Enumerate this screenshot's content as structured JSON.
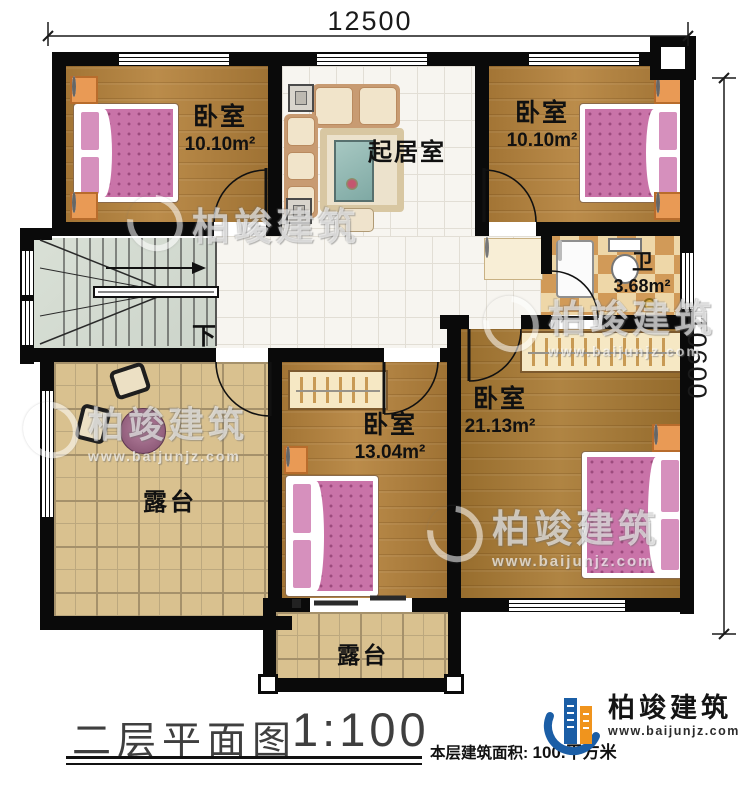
{
  "dimensions": {
    "width_label": "12500",
    "height_label": "10600"
  },
  "rooms": {
    "bedroom_top_left": {
      "label": "卧室",
      "area": "10.10m²"
    },
    "living_room": {
      "label": "起居室"
    },
    "bedroom_top_right": {
      "label": "卧室",
      "area": "10.10m²"
    },
    "bathroom": {
      "label": "卫",
      "area": "3.68m²"
    },
    "bedroom_middle": {
      "label": "卧室",
      "area": "13.04m²"
    },
    "bedroom_large": {
      "label": "卧室",
      "area": "21.13m²"
    },
    "terrace_left": {
      "label": "露台"
    },
    "terrace_bottom": {
      "label": "露台"
    },
    "stairs": {
      "direction_label": "下"
    }
  },
  "footer": {
    "plan_title": "二层平面图",
    "plan_scale": "1:100",
    "area_label": "本层建筑面积:",
    "area_value": "100.",
    "area_unit": "平方米"
  },
  "brand": {
    "name": "柏竣建筑",
    "website": "www.baijunjz.com"
  },
  "watermark": {
    "name": "柏竣建筑",
    "website": "www.baijunjz.com"
  },
  "colors": {
    "logo_blue": "#1b5ea6",
    "logo_orange": "#f0941d",
    "wall": "#0a0a0a",
    "wood_floor": "#b5823b",
    "terrace_tile": "#d9c18f",
    "bath_tile_dark": "#d19a58",
    "bed_pink": "#c973a8"
  }
}
